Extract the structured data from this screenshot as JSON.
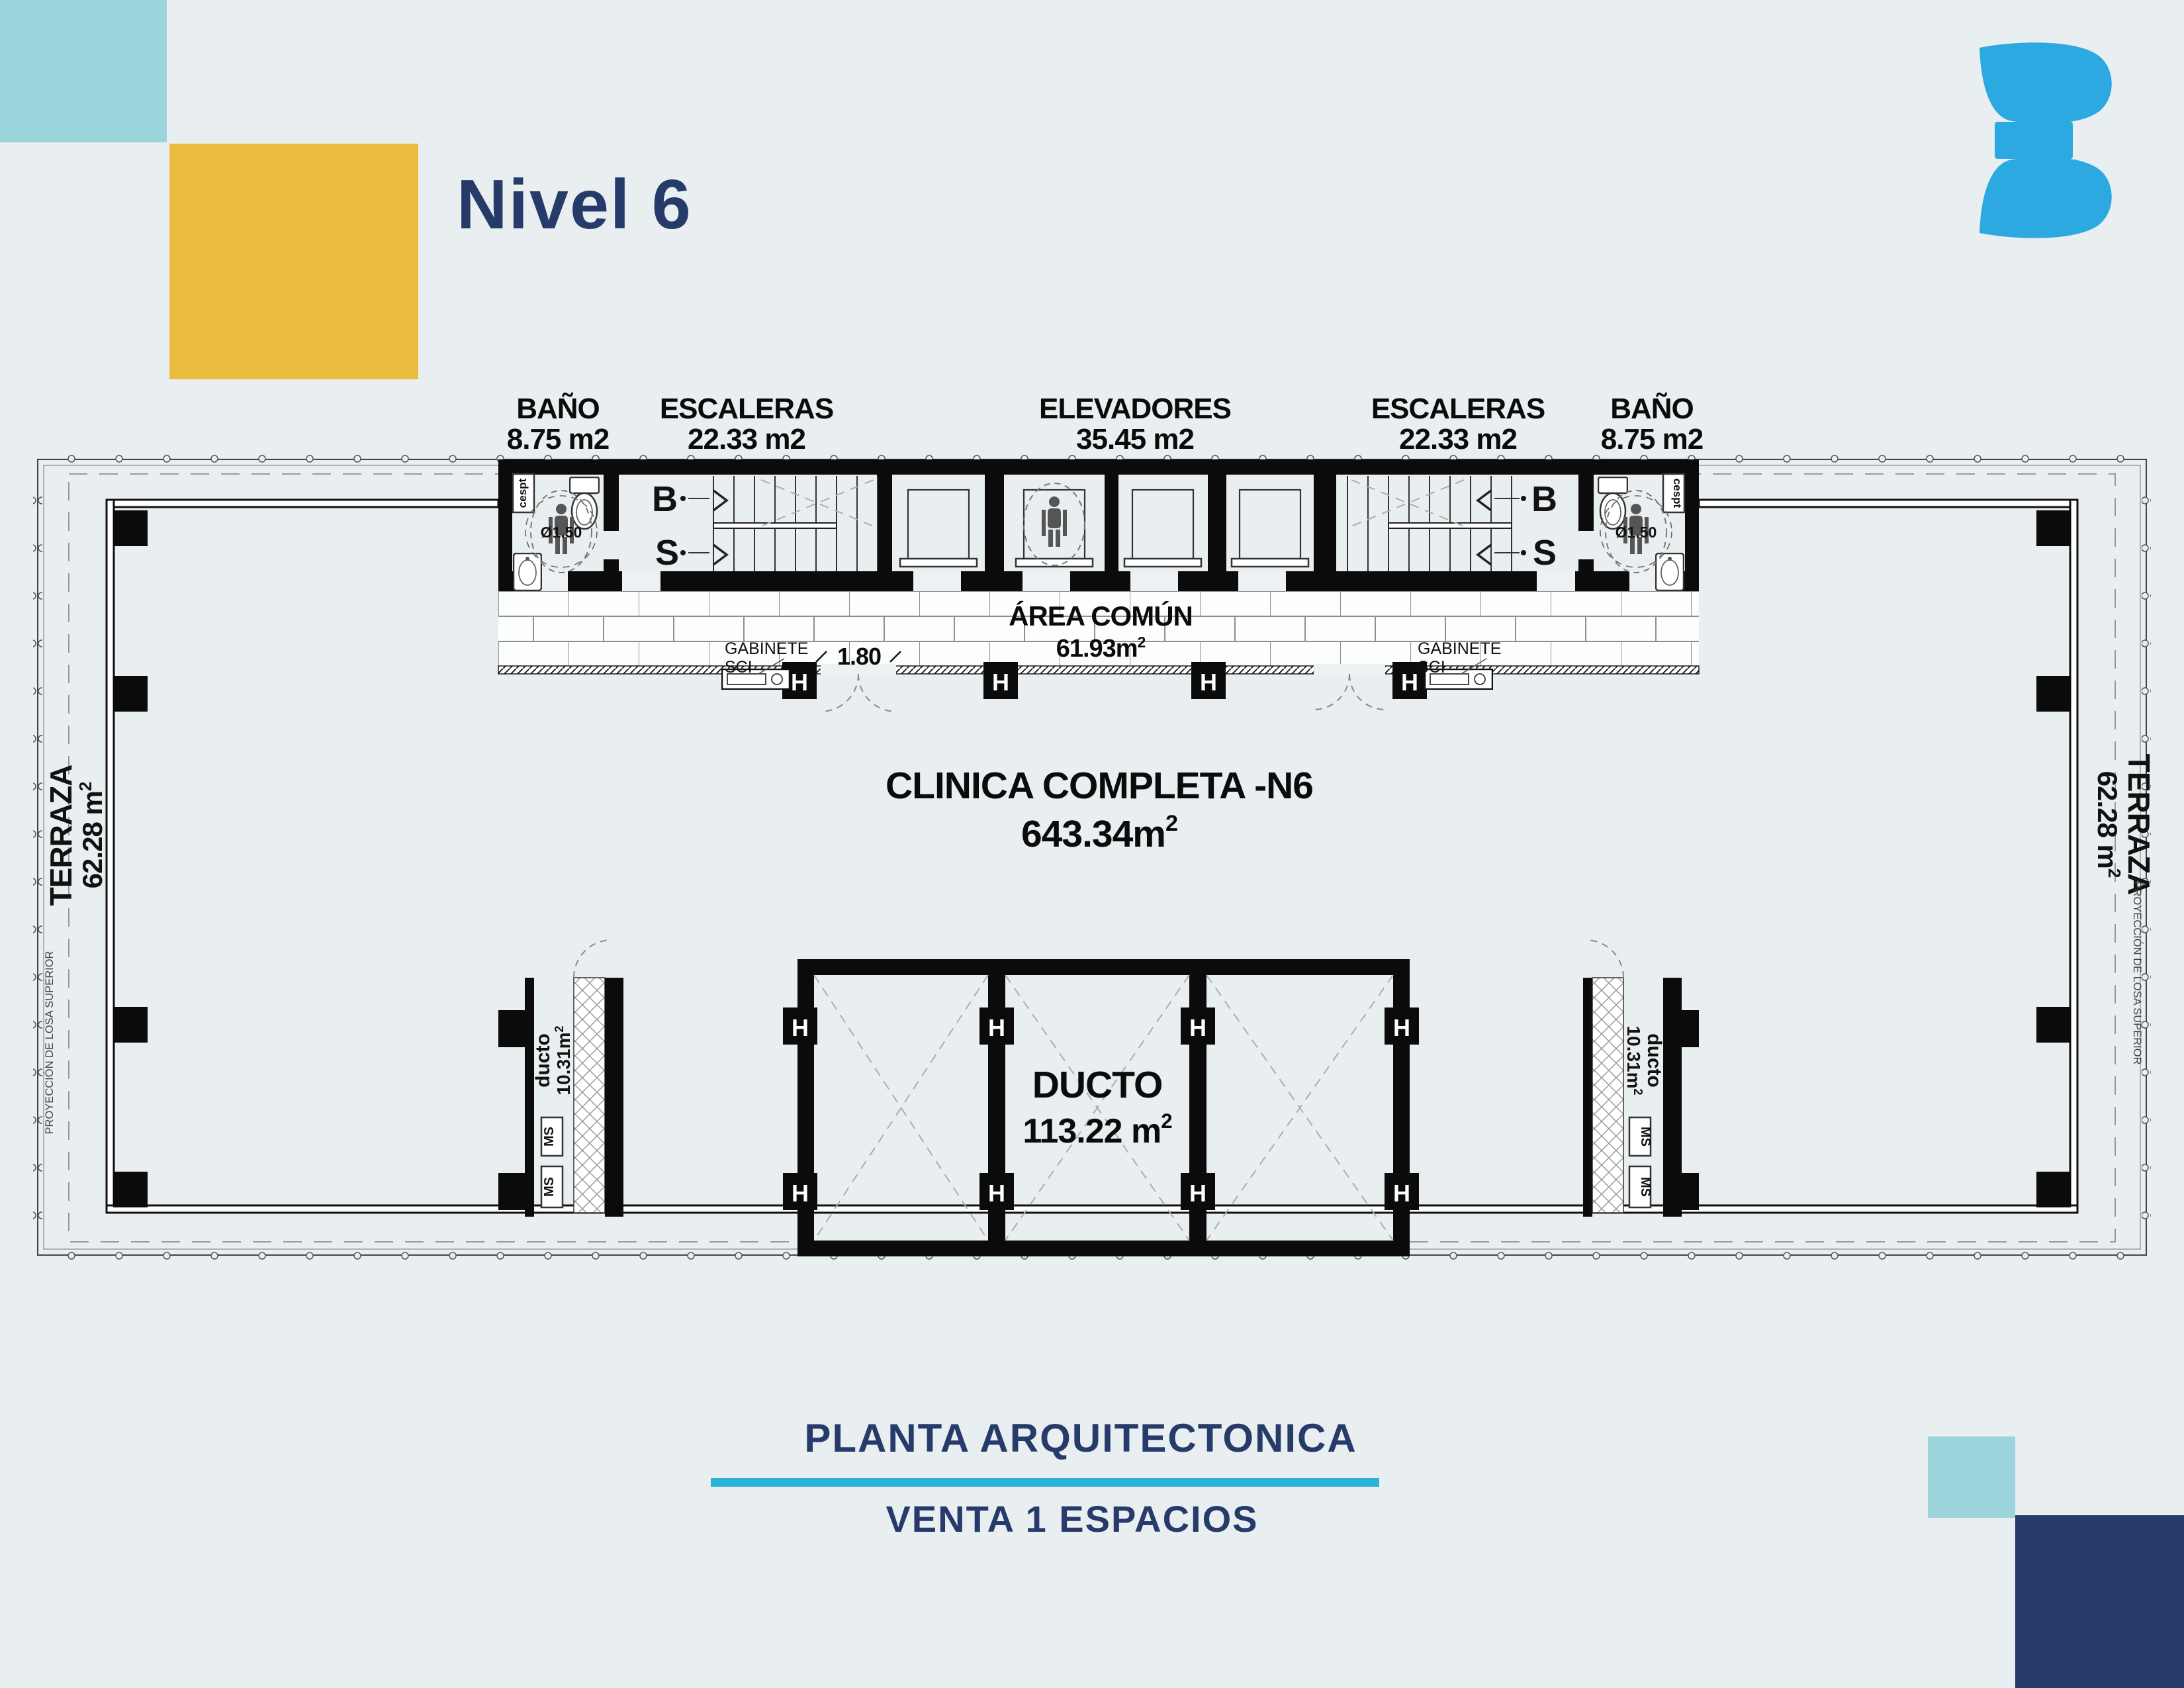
{
  "title": "Nivel 6",
  "logo": {
    "glyph": "3"
  },
  "top_labels": [
    {
      "name": "BAÑO",
      "area": "8.75 m2"
    },
    {
      "name": "ESCALERAS",
      "area": "22.33 m2"
    },
    {
      "name": "ELEVADORES",
      "area": "35.45 m2"
    },
    {
      "name": "ESCALERAS",
      "area": "22.33 m2"
    },
    {
      "name": "BAÑO",
      "area": "8.75 m2"
    }
  ],
  "plan": {
    "area_comun": {
      "name": "ÁREA COMÚN",
      "area_base": "61.93m",
      "area_sup": "2"
    },
    "clinica": {
      "name": "CLINICA COMPLETA -N6",
      "area_base": "643.34m",
      "area_sup": "2"
    },
    "ducto_central": {
      "name": "DUCTO",
      "area_base": "113.22 m",
      "area_sup": "2"
    },
    "ducto_left": {
      "name": "ducto",
      "area_base": "10.31m",
      "area_sup": "2"
    },
    "ducto_right": {
      "name": "ducto",
      "area_base": "10.31m",
      "area_sup": "2"
    },
    "terraza_left": {
      "name": "TERRAZA",
      "area_base": "62.28 m",
      "area_sup": "2"
    },
    "terraza_right": {
      "name": "TERRAZA",
      "area_base": "62.28 m",
      "area_sup": "2"
    },
    "gabinete_left": {
      "line1": "GABINETE",
      "line2": "SCI"
    },
    "gabinete_right": {
      "line1": "GABINETE",
      "line2": "SCI"
    },
    "dim_door": "1.80",
    "diam_left": "Ø1.50",
    "diam_right": "Ø1.50",
    "stairs_left": {
      "down": "B",
      "up": "S"
    },
    "stairs_right": {
      "down": "B",
      "up": "S"
    },
    "ms": "MS",
    "cespt": "cespt",
    "h_marker": "H",
    "proyeccion": "PROYECCIÓN DE LOSA SUPERIOR"
  },
  "footer": {
    "line1": "PLANTA ARQUITECTONICA",
    "line2": "VENTA 1 ESPACIOS"
  },
  "colors": {
    "background": "#e9eef1",
    "navy": "#263b6a",
    "teal": "#9cd4dc",
    "yellow": "#e9bc40",
    "cyan": "#2ab5d8",
    "logo_blue": "#2ba9e0",
    "ink": "#0b0b0b"
  }
}
